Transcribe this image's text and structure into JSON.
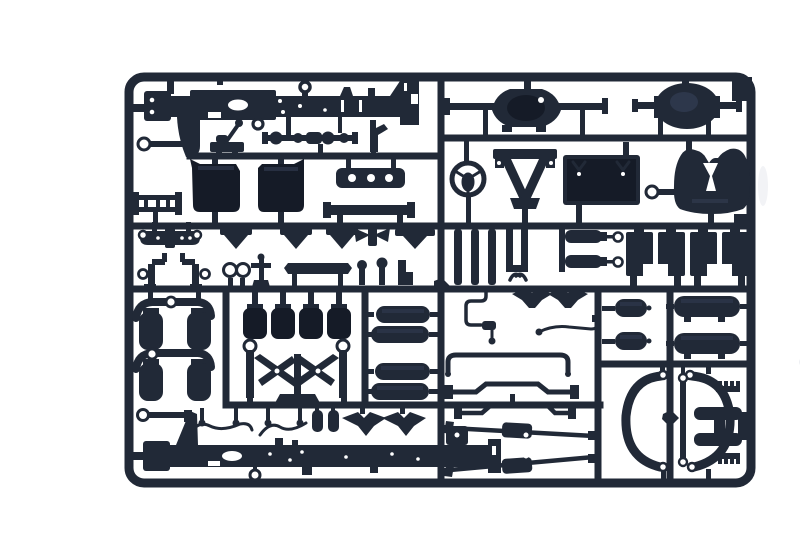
{
  "meta": {
    "subject": "Photograph of a plastic model kit sprue: dark navy-blue injection-molded truck chassis parts attached to a rectangular runner frame on a white background",
    "object_type": "model-kit-sprue-photo"
  },
  "colors": {
    "background": "#ffffff",
    "plastic": "#212937",
    "plastic_dark": "#151b27",
    "plastic_light": "#39445c",
    "shadow": "#edeff3"
  },
  "sprue": {
    "frame": {
      "shape": "rounded rectangle",
      "rows": 4,
      "full_width_runners": 3
    },
    "parts": [
      {
        "id": "chassis-rail-top",
        "label": "truck chassis side rail, upper"
      },
      {
        "id": "gusset-bracket-top",
        "label": "triangular gusset bracket"
      },
      {
        "id": "drag-link-top",
        "label": "drag link rod with eye"
      },
      {
        "id": "gear-lever",
        "label": "gear lever assembly"
      },
      {
        "id": "drive-shaft",
        "label": "drive shaft with universal joints"
      },
      {
        "id": "fork-bracket",
        "label": "forked bracket"
      },
      {
        "id": "rear-axle-1",
        "label": "rear axle with differential housing"
      },
      {
        "id": "rear-axle-2",
        "label": "second axle housing"
      },
      {
        "id": "engine-block-1",
        "label": "engine block half"
      },
      {
        "id": "engine-block-2",
        "label": "engine block half"
      },
      {
        "id": "cross-member",
        "label": "ladder cross member"
      },
      {
        "id": "drilled-beam",
        "label": "drilled beam with three holes"
      },
      {
        "id": "bumper-bar",
        "label": "bumper bar"
      },
      {
        "id": "steering-wheel",
        "label": "steering wheel"
      },
      {
        "id": "a-frame-mount",
        "label": "A-frame engine mount"
      },
      {
        "id": "radiator",
        "label": "radiator panel"
      },
      {
        "id": "crank-key",
        "label": "starting crank / key part"
      },
      {
        "id": "fifth-wheel",
        "label": "fifth wheel coupling plate"
      },
      {
        "id": "leaf-spring",
        "label": "leaf spring with eyes"
      },
      {
        "id": "spring-hangers",
        "label": "spring hanger brackets row"
      },
      {
        "id": "tow-hooks",
        "label": "tow hooks"
      },
      {
        "id": "shackle-rings",
        "label": "shackle rings"
      },
      {
        "id": "anchor-pin",
        "label": "cross-shaped anchor pin"
      },
      {
        "id": "flat-plate",
        "label": "flat cover plate"
      },
      {
        "id": "mushroom-pins",
        "label": "round-head pins"
      },
      {
        "id": "l-bracket",
        "label": "L bracket"
      },
      {
        "id": "spring-strips",
        "label": "vertical leaf-spring strips"
      },
      {
        "id": "brake-cylinders",
        "label": "brake cylinders with eye rods"
      },
      {
        "id": "spring-blocks",
        "label": "suspension spring blocks"
      },
      {
        "id": "shock-tower-1",
        "label": "axle beam with air springs"
      },
      {
        "id": "shock-tower-2",
        "label": "axle beam with air springs"
      },
      {
        "id": "engine-cylinders",
        "label": "cylinder blocks row"
      },
      {
        "id": "v-linkage",
        "label": "V-stay suspension linkage"
      },
      {
        "id": "fuel-tanks",
        "label": "cylindrical fuel tanks"
      },
      {
        "id": "brake-line",
        "label": "bent brake line"
      },
      {
        "id": "wing-brackets-top",
        "label": "winged mudflap brackets"
      },
      {
        "id": "air-line",
        "label": "air line with fitting"
      },
      {
        "id": "u-pipe",
        "label": "U-shaped exhaust pipe"
      },
      {
        "id": "stabilizer-bar-1",
        "label": "anti-roll stabilizer bar"
      },
      {
        "id": "air-tanks-small",
        "label": "small air reservoirs"
      },
      {
        "id": "air-tanks-large",
        "label": "large air reservoirs"
      },
      {
        "id": "wheel-arch-left",
        "label": "wheel arch fender, left"
      },
      {
        "id": "wheel-arch-right",
        "label": "wheel arch fender, right"
      },
      {
        "id": "link-rod",
        "label": "link rod with eyes"
      },
      {
        "id": "h-ladder",
        "label": "H-shaped frame member"
      },
      {
        "id": "toothed-clips",
        "label": "toothed rack clips"
      },
      {
        "id": "torque-rods",
        "label": "torque rods with pads"
      },
      {
        "id": "stabilizer-bar-2",
        "label": "anti-roll stabilizer bar"
      },
      {
        "id": "chassis-rail-bottom",
        "label": "truck chassis side rail, lower"
      },
      {
        "id": "gusset-bracket-bottom",
        "label": "triangular gusset bracket"
      },
      {
        "id": "drag-link-bottom",
        "label": "drag link rod with eye"
      },
      {
        "id": "brake-lines-bottom",
        "label": "wavy brake lines with valves"
      },
      {
        "id": "small-capsules",
        "label": "small cylinder pair"
      },
      {
        "id": "wing-brackets-bottom",
        "label": "winged mudflap brackets"
      }
    ]
  }
}
